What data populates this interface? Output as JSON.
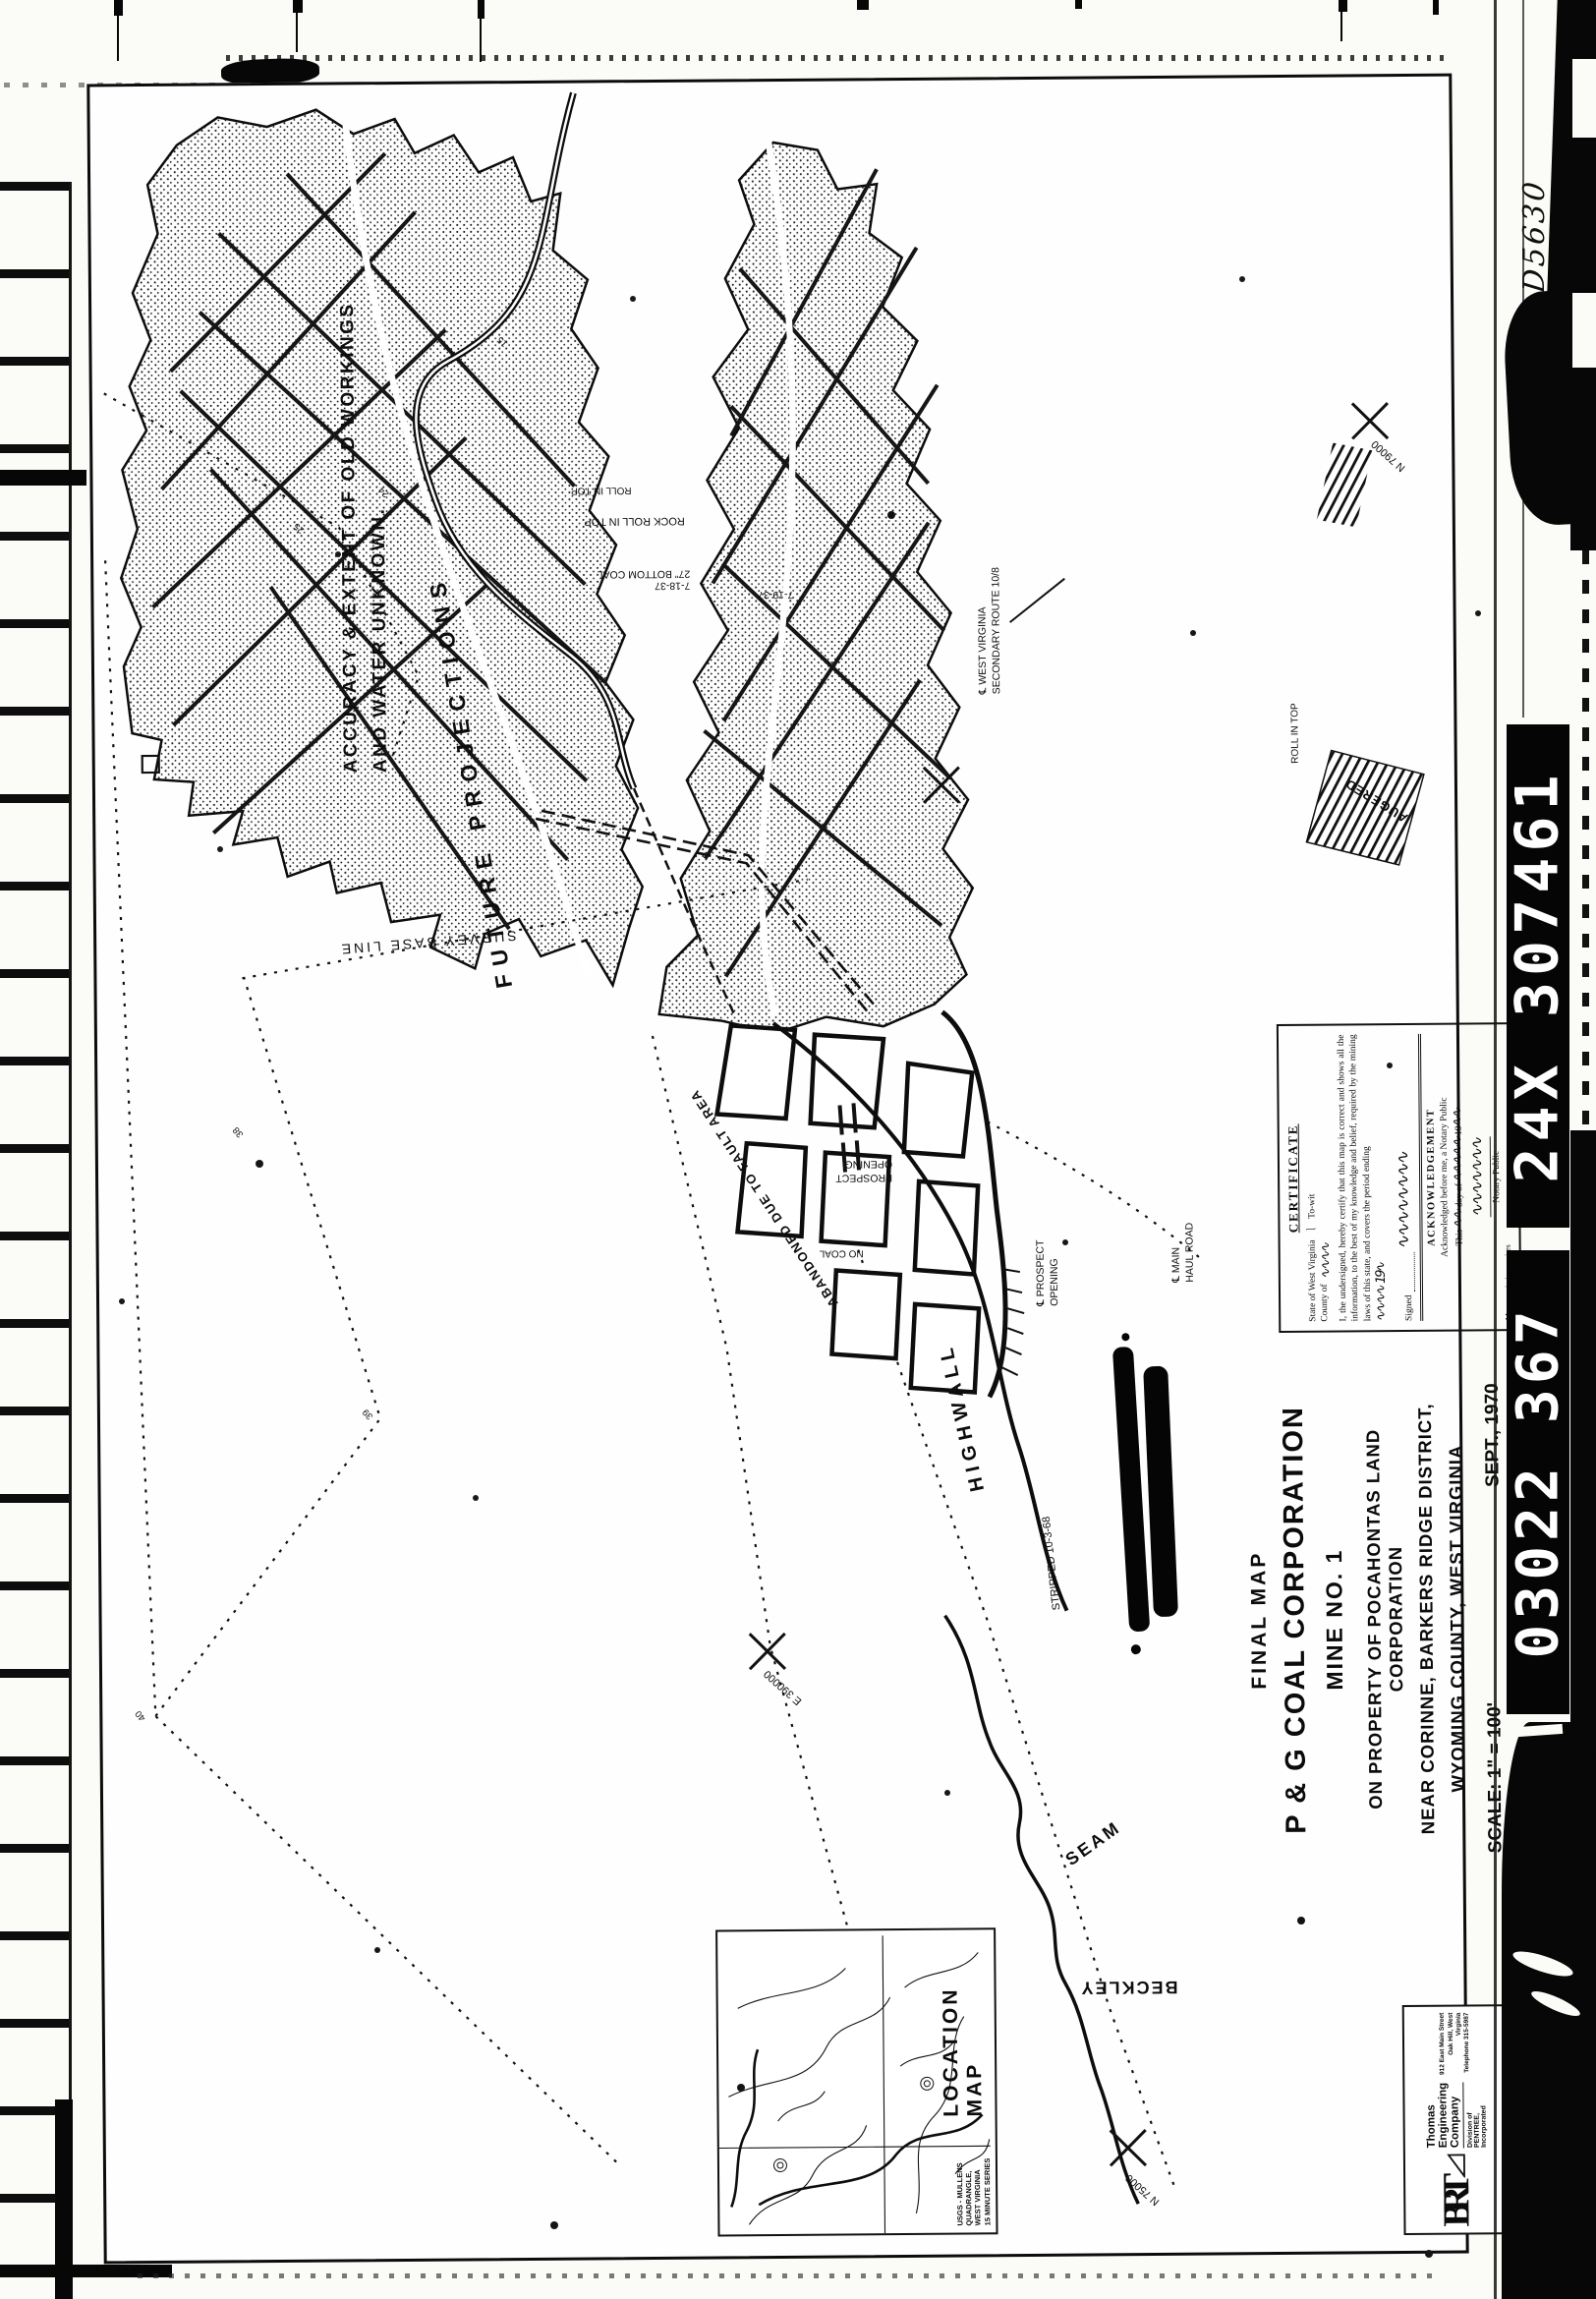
{
  "film": {
    "handwritten_frame_number": "D5630",
    "id_bar_upper": "24X 307461",
    "id_bar_lower": "03022  367"
  },
  "title_block": {
    "doc_type": "FINAL MAP",
    "company": "P & G COAL CORPORATION",
    "mine": "MINE NO. 1",
    "property": "ON PROPERTY OF  POCAHONTAS LAND CORPORATION",
    "district": "NEAR CORINNE, BARKERS RIDGE DISTRICT,",
    "county": "WYOMING COUNTY, WEST VIRGINIA",
    "scale": "SCALE: 1\" = 100'",
    "date": "SEPT., 1970"
  },
  "certificate": {
    "title": "CERTIFICATE",
    "state_line": "State of West Virginia",
    "county_label": "County of",
    "county_scribble": "∿∿∿∿",
    "towit": "To-wit",
    "body": "I, the undersigned, hereby certify that this map is correct and shows all the information, to the best of my knowledge and belief, required by the mining laws of this state, and covers the period ending",
    "period_scribble": "∿∿∿∿ 19∿",
    "signed_label": "Signed",
    "signature_scribble": "∿∿∿∿∿∿∿∿",
    "ack_title": "ACKNOWLEDGEMENT",
    "ack_line1": "Acknowledged before me, a Notary Public",
    "ack_this": "This",
    "ack_day_scribble": "∿∿",
    "ack_dayof": "day of",
    "ack_month_scribble": "∿∿∿∿∿",
    "ack_year": "19",
    "ack_year_scribble": "∿∿",
    "notary_signature_scribble": "∿∿∿∿∿∿∿",
    "notary_label": "Notary Public",
    "commission_line": "My commission expires"
  },
  "location_map": {
    "title": "LOCATION MAP",
    "caption_lines": [
      "USGS - MULLENS",
      "QUADRANGLE,",
      "WEST VIRGINIA",
      "15 MINUTE SERIES"
    ]
  },
  "stamp": {
    "logo": "BRT",
    "firm": "Thomas Engineering Company",
    "division": "Division of PENTREE, Incorporated",
    "address": [
      "912 East Main Street",
      "Oak Hill, West Virginia",
      "Telephone 315-5987"
    ]
  },
  "annotations": {
    "accuracy_1": "ACCURACY & EXTENT OF OLD WORKINGS",
    "accuracy_2": "AND WATER UNKNOWN.",
    "future_projections": "FUTURE   PROJECTIONS",
    "survey_base_line": "SURVEY  BASE  LINE",
    "highwall": "HIGHWALL",
    "beckley": "BECKLEY",
    "seam": "SEAM",
    "augered": "AUGERED",
    "abandoned": "ABANDONED DUE TO FAULT AREA",
    "rock_roll_in_top": "ROCK ROLL IN TOP",
    "roll_in_top": "ROLL IN TOP",
    "bottom_coal": "27\" BOTTOM COAL",
    "date_a": "7-18-37",
    "date_b": "7-19-37",
    "route_1": "℄ WEST VIRGINIA",
    "route_2": "SECONDARY ROUTE 10/8",
    "haul_1": "℄ MAIN",
    "haul_2": "HAUL ROAD",
    "prospect_1": "PROSPECT",
    "prospect_2": "OPENING",
    "cl_prospect_1": "℄ PROSPECT",
    "cl_prospect_2": "OPENING",
    "no_coal": "NO COAL",
    "stripped": "STRIPPED 10-3-68",
    "grid_n75000": "N 75000",
    "grid_e390000": "E 390000",
    "grid_n79000": "N 79000",
    "stations": [
      "40",
      "39",
      "38",
      "25",
      "24",
      "15"
    ]
  }
}
